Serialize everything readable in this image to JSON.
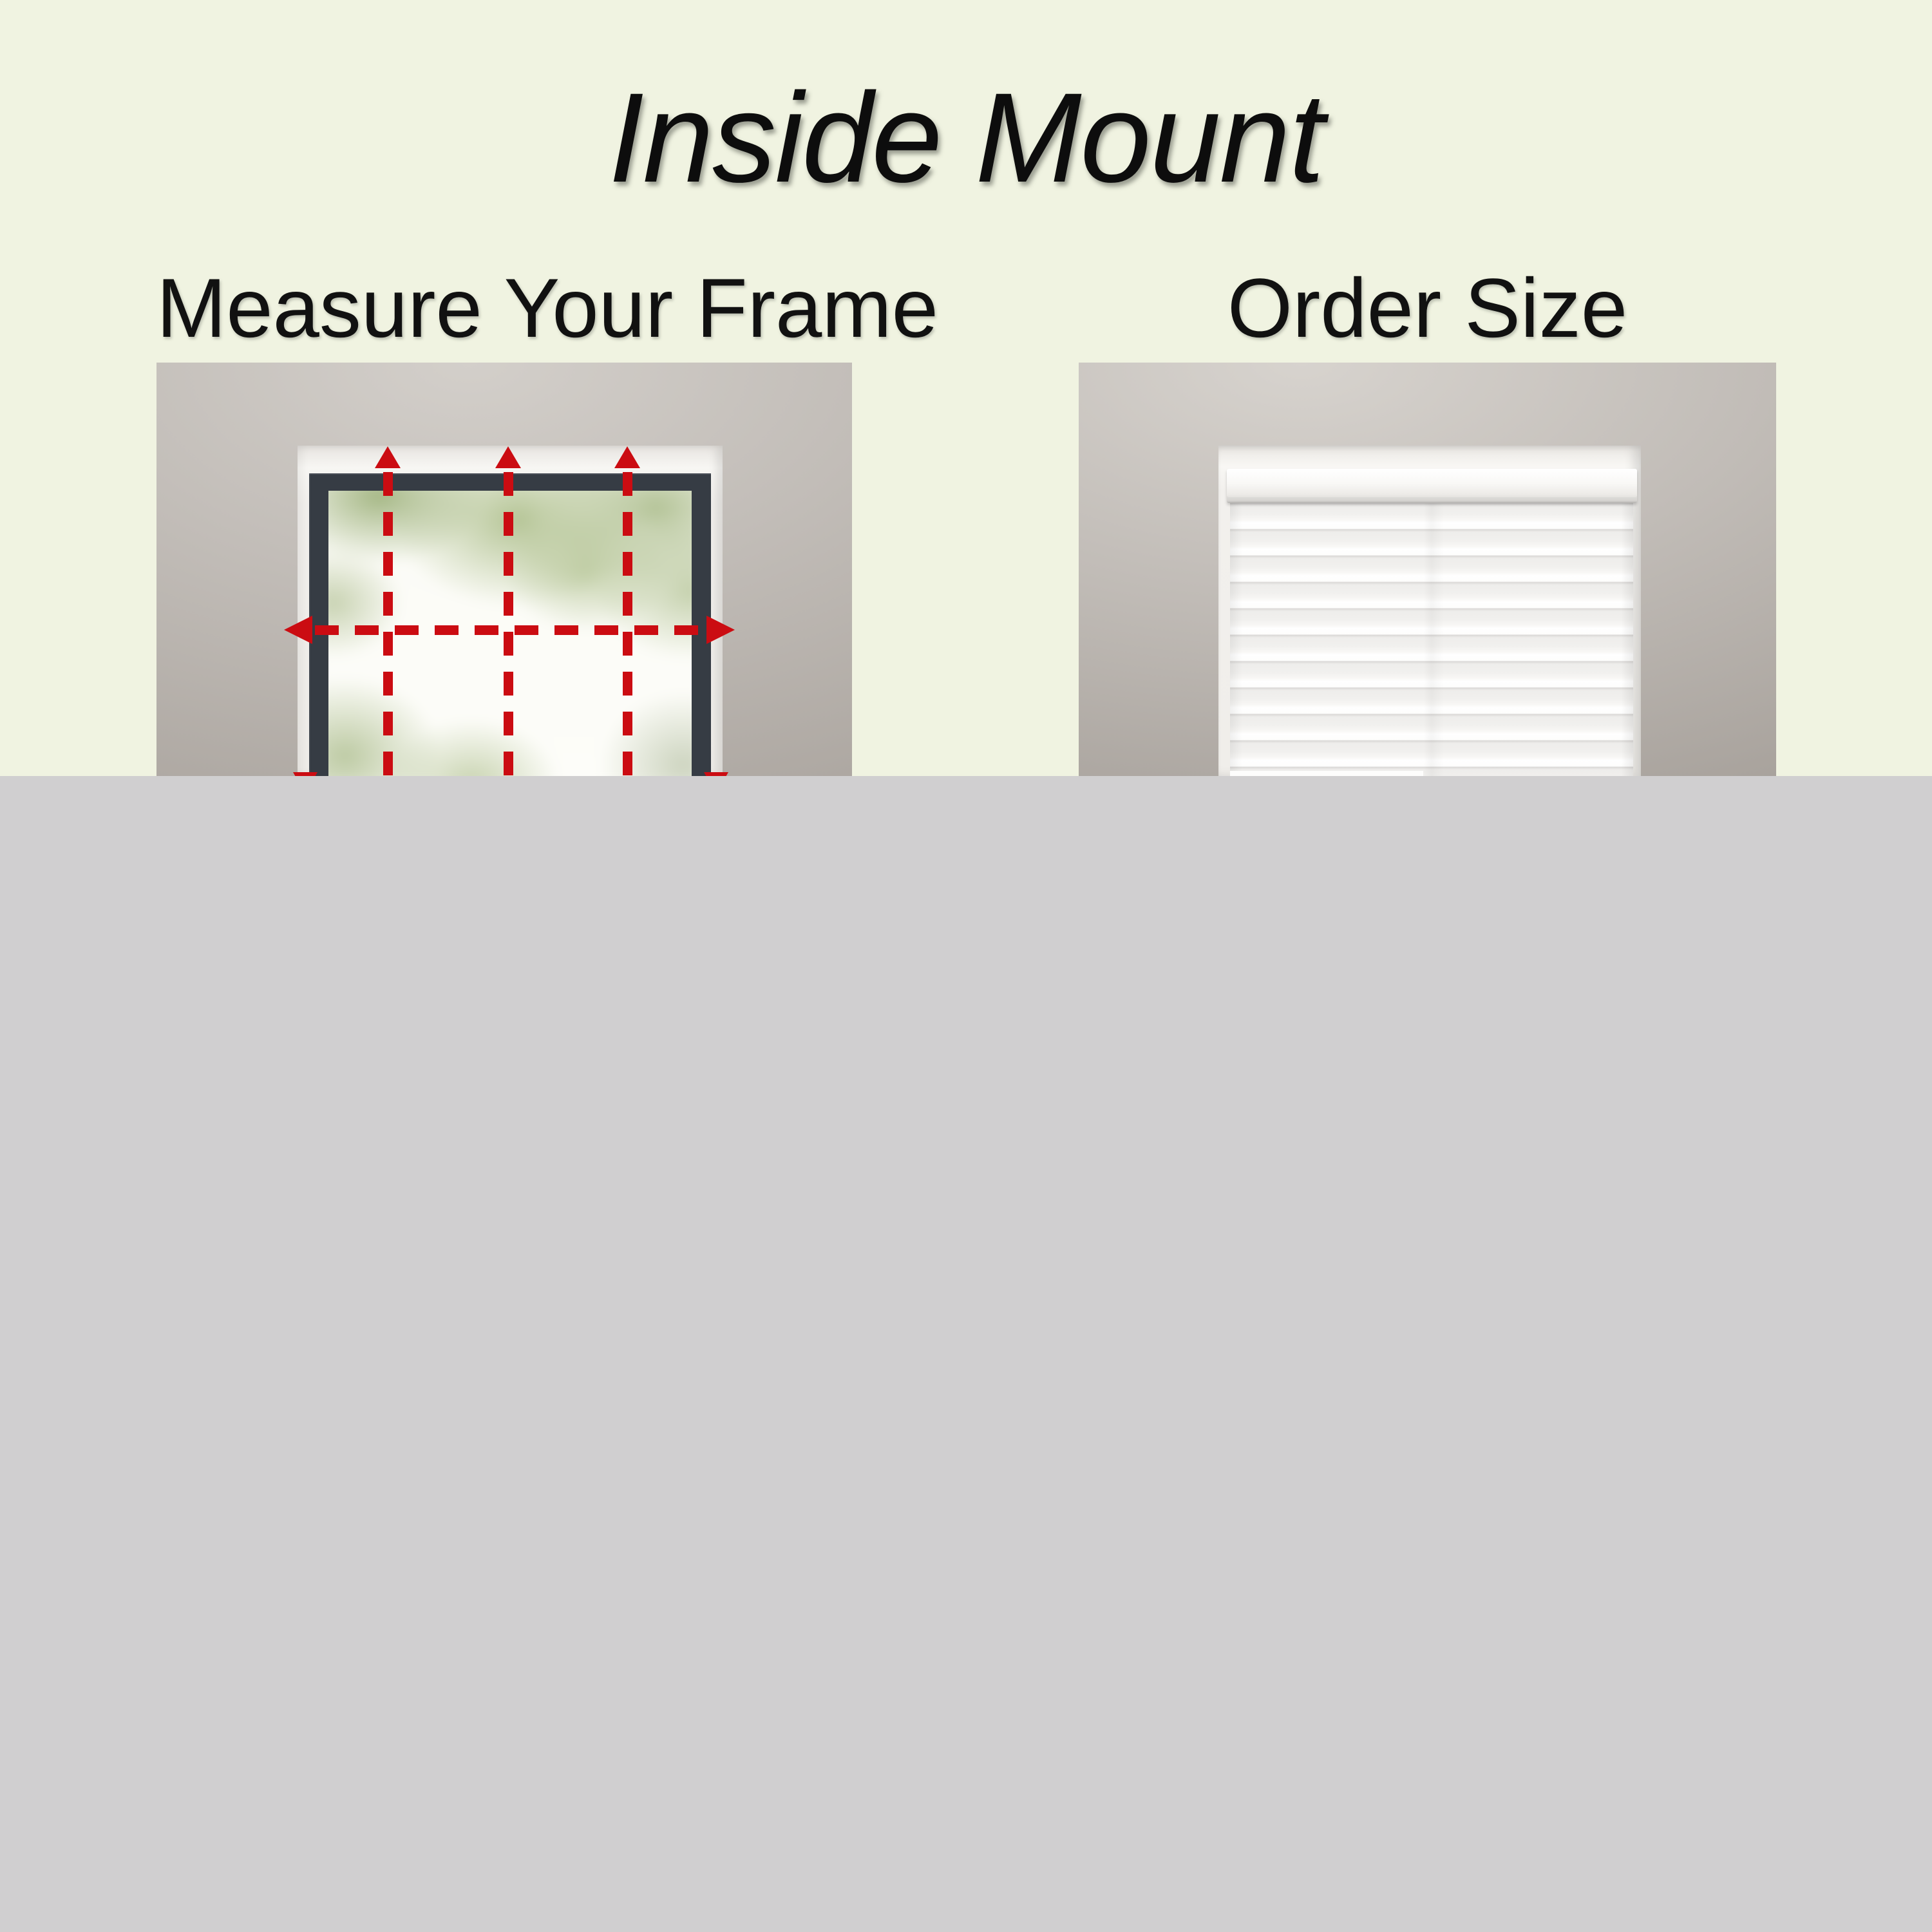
{
  "title": "Inside Mount",
  "sections": [
    {
      "label": "Measure Your Frame",
      "photo": "window with red dashed measuring arrows inside frame"
    },
    {
      "label": "Order Size",
      "photo": "window with white zebra blind installed inside frame"
    }
  ],
  "annotations": {
    "vertical_up_arrows": 3,
    "horizontal_double_arrow": 1
  },
  "colors": {
    "page_background": "#f0f3e1",
    "bottom_overlay": "#d0cfd0",
    "measurement_red": "#cb0c12",
    "window_frame_dark": "#363c44",
    "wall_gray": "#c1bcb7",
    "niche_white": "#f2f0ed",
    "blind_white": "#fbfbf9",
    "text_black": "#0d0d0d"
  }
}
